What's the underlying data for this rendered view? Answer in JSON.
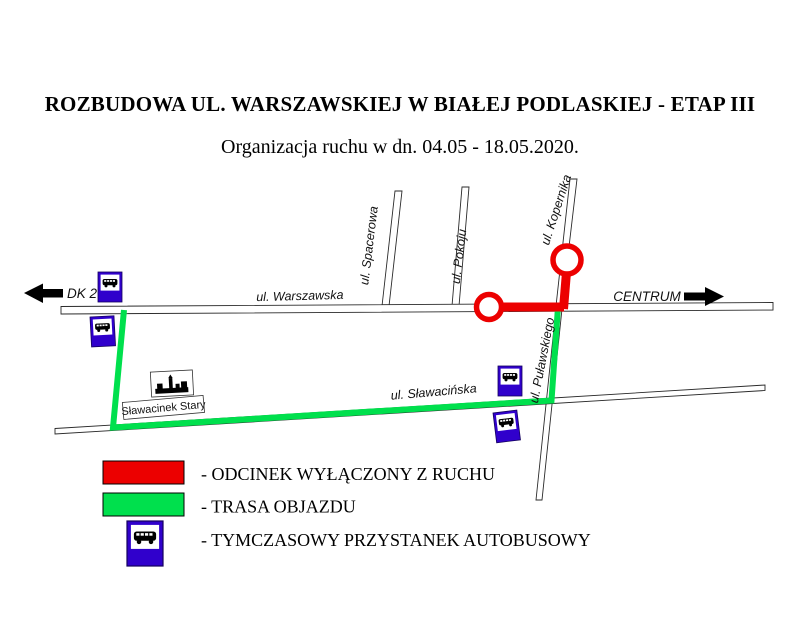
{
  "header": {
    "title": "ROZBUDOWA UL. WARSZAWSKIEJ W BIAŁEJ PODLASKIEJ - ETAP III",
    "subtitle": "Organizacja ruchu w dn. 04.05 - 18.05.2020."
  },
  "map": {
    "street_labels": {
      "warszawska": "ul. Warszawska",
      "spacerowa": "ul. Spacerowa",
      "pokoju": "ul. Pokoju",
      "kopernika": "ul. Kopernika",
      "pulaskiego": "ul. Puławskiego",
      "slawacinska": "ul. Sławacińska"
    },
    "direction_west": "DK 2",
    "direction_east": "CENTRUM",
    "place_label": "Sławacinek Stary",
    "icons": {
      "bus_stop": "bus-stop-sign-icon",
      "town": "town-silhouette-icon",
      "arrow_west": "arrow-left-icon",
      "arrow_east": "arrow-right-icon"
    }
  },
  "legend": {
    "items": [
      {
        "symbol": "red-rect",
        "color": "#ec0000",
        "label": "- ODCINEK WYŁĄCZONY Z RUCHU"
      },
      {
        "symbol": "green-rect",
        "color": "#00e04d",
        "label": "- TRASA OBJAZDU"
      },
      {
        "symbol": "bus-stop-sign",
        "color": "#3000cc",
        "label": "- TYMCZASOWY PRZYSTANEK AUTOBUSOWY"
      }
    ]
  },
  "colors": {
    "closed_section": "#ec0000",
    "detour_route": "#00e04d",
    "bus_sign_blue": "#3000cc"
  }
}
